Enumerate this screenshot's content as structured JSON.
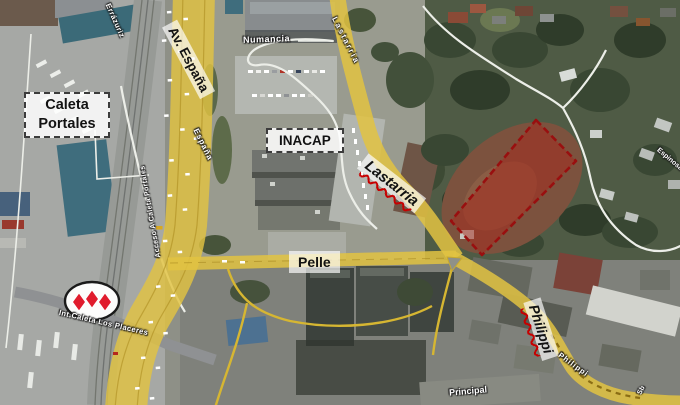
{
  "map": {
    "place_labels": {
      "caleta_portales": {
        "line1": "Caleta",
        "line2": "Portales"
      },
      "inacap": "INACAP"
    },
    "road_labels": {
      "av_espana": "Av. España",
      "lastarria": "Lastarria",
      "pelle": "Pelle",
      "philippi": "Philippi"
    },
    "street_names": {
      "errazuriz": "Errázuriz",
      "numancia": "Numancia",
      "espana_small": "España",
      "lastarria_small": "Lastarria",
      "acceso": "Acceso A Caleta Portales",
      "int_caleta_los_placeres": "Int.Caleta Los Placeres",
      "philippi_small": "Philippi",
      "principal": "Principal",
      "espinosa": "Espinosa",
      "sb": "Sb"
    },
    "icons": {
      "logo": "three-red-diamonds-logo"
    },
    "colors": {
      "road_overlay_yellow": "#e2c342",
      "highlight_fill": "#a8362a",
      "highlight_border": "#990f0f",
      "label_underline_red": "#c70000",
      "logo_diamond_red": "#e01b2c"
    }
  }
}
